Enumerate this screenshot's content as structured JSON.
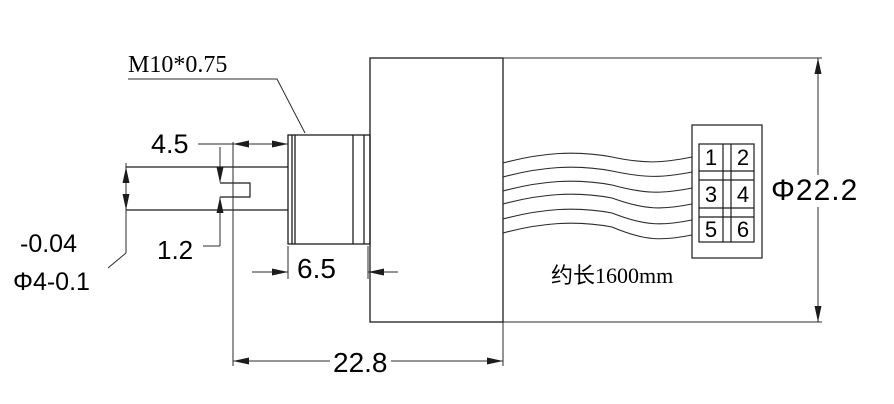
{
  "drawing": {
    "labels": {
      "thread_spec": "M10*0.75",
      "flat_length": "4.5",
      "flat_depth": "1.2",
      "shaft_tolerance_upper": "-0.04",
      "shaft_diameter": "Φ4-0.1",
      "boss_length": "6.5",
      "total_length": "22.8",
      "body_diameter": "Φ22.2",
      "wire_length_note": "约长1600mm"
    },
    "connector_pins": [
      "1",
      "2",
      "3",
      "4",
      "5",
      "6"
    ],
    "colors": {
      "outline": "#1c1c1c",
      "dimension": "#2b2b2b",
      "text": "#000000",
      "background": "#ffffff"
    }
  }
}
